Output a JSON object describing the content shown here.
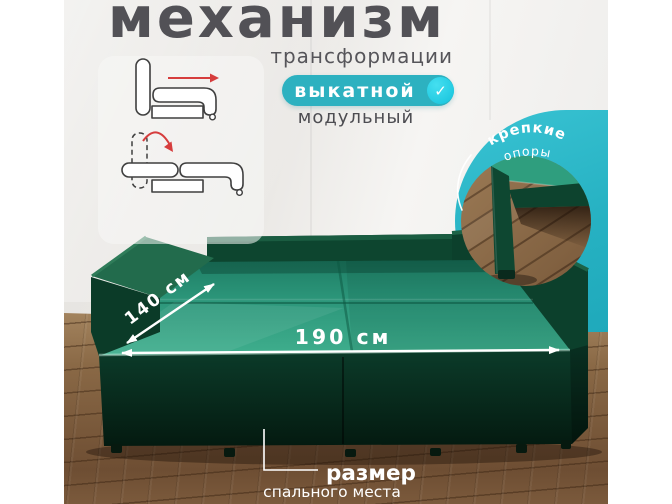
{
  "header": {
    "title": "механизм",
    "subtitle": "трансформации",
    "badge_label": "выкатной",
    "badge_check": "✓",
    "secondary_option": "модульный"
  },
  "supports_callout": {
    "line1": "крепкие",
    "line2": "опоры"
  },
  "dimensions": {
    "depth_label": "140 см",
    "width_label": "190 см"
  },
  "caption": {
    "title": "размер",
    "subtitle": "спального места"
  },
  "palette": {
    "accent_teal": "#2db1c0",
    "check_cyan": "#1fc9e0",
    "mattress_green": "#2f9c7d",
    "frame_dark_green": "#0c402c",
    "base_dark_green": "#0b3a29",
    "headline_gray": "#525156",
    "arrow_red": "#d63d3d",
    "wood_brown": "#8a6946",
    "label_white": "#ffffff"
  }
}
